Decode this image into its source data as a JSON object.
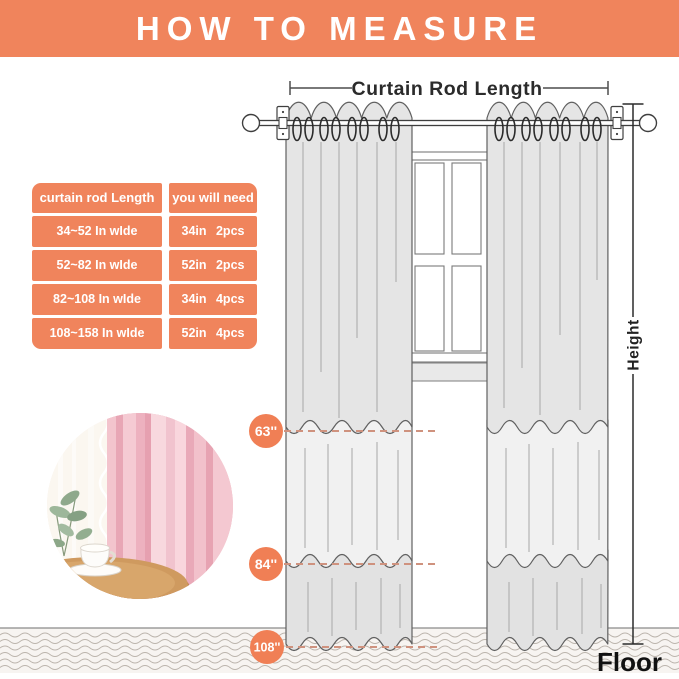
{
  "header": {
    "title": "HOW TO MEASURE"
  },
  "size_table": {
    "headers": [
      "curtain rod Length",
      "you will need"
    ],
    "rows": [
      {
        "rod": "34~52 In wIde",
        "need": "34in 2pcs"
      },
      {
        "rod": "52~82 In wIde",
        "need": "52in 2pcs"
      },
      {
        "rod": "82~108 In wIde",
        "need": "34in 4pcs"
      },
      {
        "rod": "108~158 In wIde",
        "need": "52in 4pcs"
      }
    ]
  },
  "diagram": {
    "rod_length_label": "Curtain Rod Length",
    "height_label": "Height",
    "floor_label": "Floor",
    "length_markers": [
      {
        "label": "63''"
      },
      {
        "label": "84''"
      },
      {
        "label": "108''"
      }
    ]
  },
  "colors": {
    "accent_coral": "#f0845c",
    "marker_coral": "#f07f55",
    "dashed_line": "#cf927e",
    "curtain_gray": "#e4e4e4",
    "curtain_gray_light": "#f1f1f1",
    "floor_bg": "#f7f4f1",
    "photo_pink": "#eeb3c0"
  }
}
